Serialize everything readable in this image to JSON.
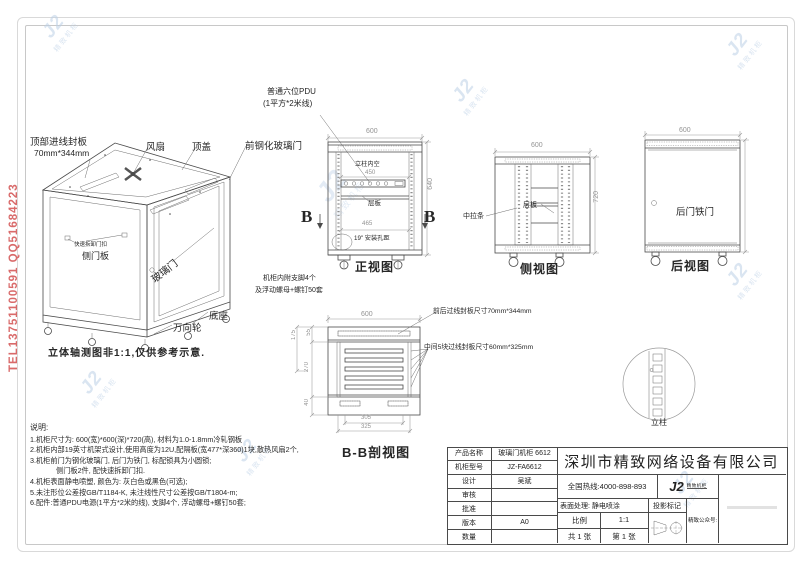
{
  "watermarks": {
    "phone_text": "TEL13751100591 QQ51684223",
    "phone_color": "#d96a6a",
    "logo_main": "J2",
    "logo_text": "精致机柜",
    "logo_color": "#bcd0e6"
  },
  "iso_view": {
    "caption": "立体轴测图非1:1,仅供参考示意.",
    "labels": {
      "top_panel": "顶部进线封板",
      "top_panel_size": "70mm*344mm",
      "fan": "风扇",
      "top_cover": "顶盖",
      "front_glass_door": "前钢化玻璃门",
      "quick_latch": "快速拆卸门扣",
      "side_panel": "侧门板",
      "glass_door": "玻璃门",
      "base": "底座",
      "casters": "万向轮"
    }
  },
  "front_view": {
    "caption": "正视图",
    "pdu_note_1": "普通六位PDU",
    "pdu_note_2": "(1平方*2米线)",
    "dim_width": "600",
    "dim_height": "640",
    "label_inner": "立柱内空",
    "dim_inner_width": "450",
    "label_shelf": "层板",
    "dim_hole_width": "465",
    "label_hole": "19\" 安装孔距",
    "section_mark": "B",
    "feet_note_1": "机柜内附支脚4个",
    "feet_note_2": "及浮动螺母+螺钉50套"
  },
  "side_view": {
    "caption": "侧视图",
    "dim_width": "600",
    "dim_height": "720",
    "label_tie": "中拉条",
    "label_shelf": "层板"
  },
  "rear_view": {
    "caption": "后视图",
    "dim_width": "600",
    "label_door": "后门铁门"
  },
  "section_view": {
    "caption": "B-B剖视图",
    "dim_width": "600",
    "dim_left_outer": "175",
    "dim_left_top": "55",
    "dim_left_mid": "270",
    "dim_left_bottom": "40",
    "dim_bottom_inner": "305",
    "dim_bottom_outer": "325",
    "note_top_panel": "前后过线封板尺寸70mm*344mm",
    "note_mid_panels": "中间5块过线封板尺寸60mm*325mm"
  },
  "detail_view": {
    "label": "立柱"
  },
  "notes": {
    "title": "说明:",
    "lines": [
      "1.机柜尺寸为: 600(宽)*600(深)*720(高), 材料为1.0-1.8mm冷轧钢板",
      "2.机柜内部19英寸机架式设计,使用高度为12U,配隔板(宽477*深360)1块,散热风扇2个,",
      "3.机柜前门为钢化玻璃门, 后门为铁门, 标配锁具为小圆锁;",
      "侧门板2件, 配快速拆卸门扣.",
      "4.机柜表面静电喷塑, 颜色为: 灰白色或黑色(可选);",
      "5.未注形位公差按GB/T1184-K, 未注线性尺寸公差按GB/T1804-m;",
      "6.配件:普通PDU电源(1平方*2米的线), 支脚4个, 浮动螺母+螺钉50套;"
    ]
  },
  "title_block": {
    "rows": [
      {
        "label": "产品名称",
        "value": "玻璃门机柜 6612"
      },
      {
        "label": "机柜型号",
        "value": "JZ-FA6612"
      },
      {
        "label": "设计",
        "value": "吴斌"
      },
      {
        "label": "审核",
        "value": ""
      },
      {
        "label": "批准",
        "value": ""
      },
      {
        "label": "版本",
        "value": "A0"
      },
      {
        "label": "数量",
        "value": ""
      }
    ],
    "company": "深圳市精致网络设备有限公司",
    "hotline": "全国热线:4000-898-893",
    "surface_label": "表面处理: 静电喷涂",
    "projection_label": "投影标记",
    "scale_label": "比例",
    "scale_value": "1:1",
    "sheet_total": "共 1 张",
    "sheet_no": "第 1 张",
    "wechat_label": "精致公众号:",
    "logo_main": "J2",
    "logo_caption": "精致机柜"
  }
}
